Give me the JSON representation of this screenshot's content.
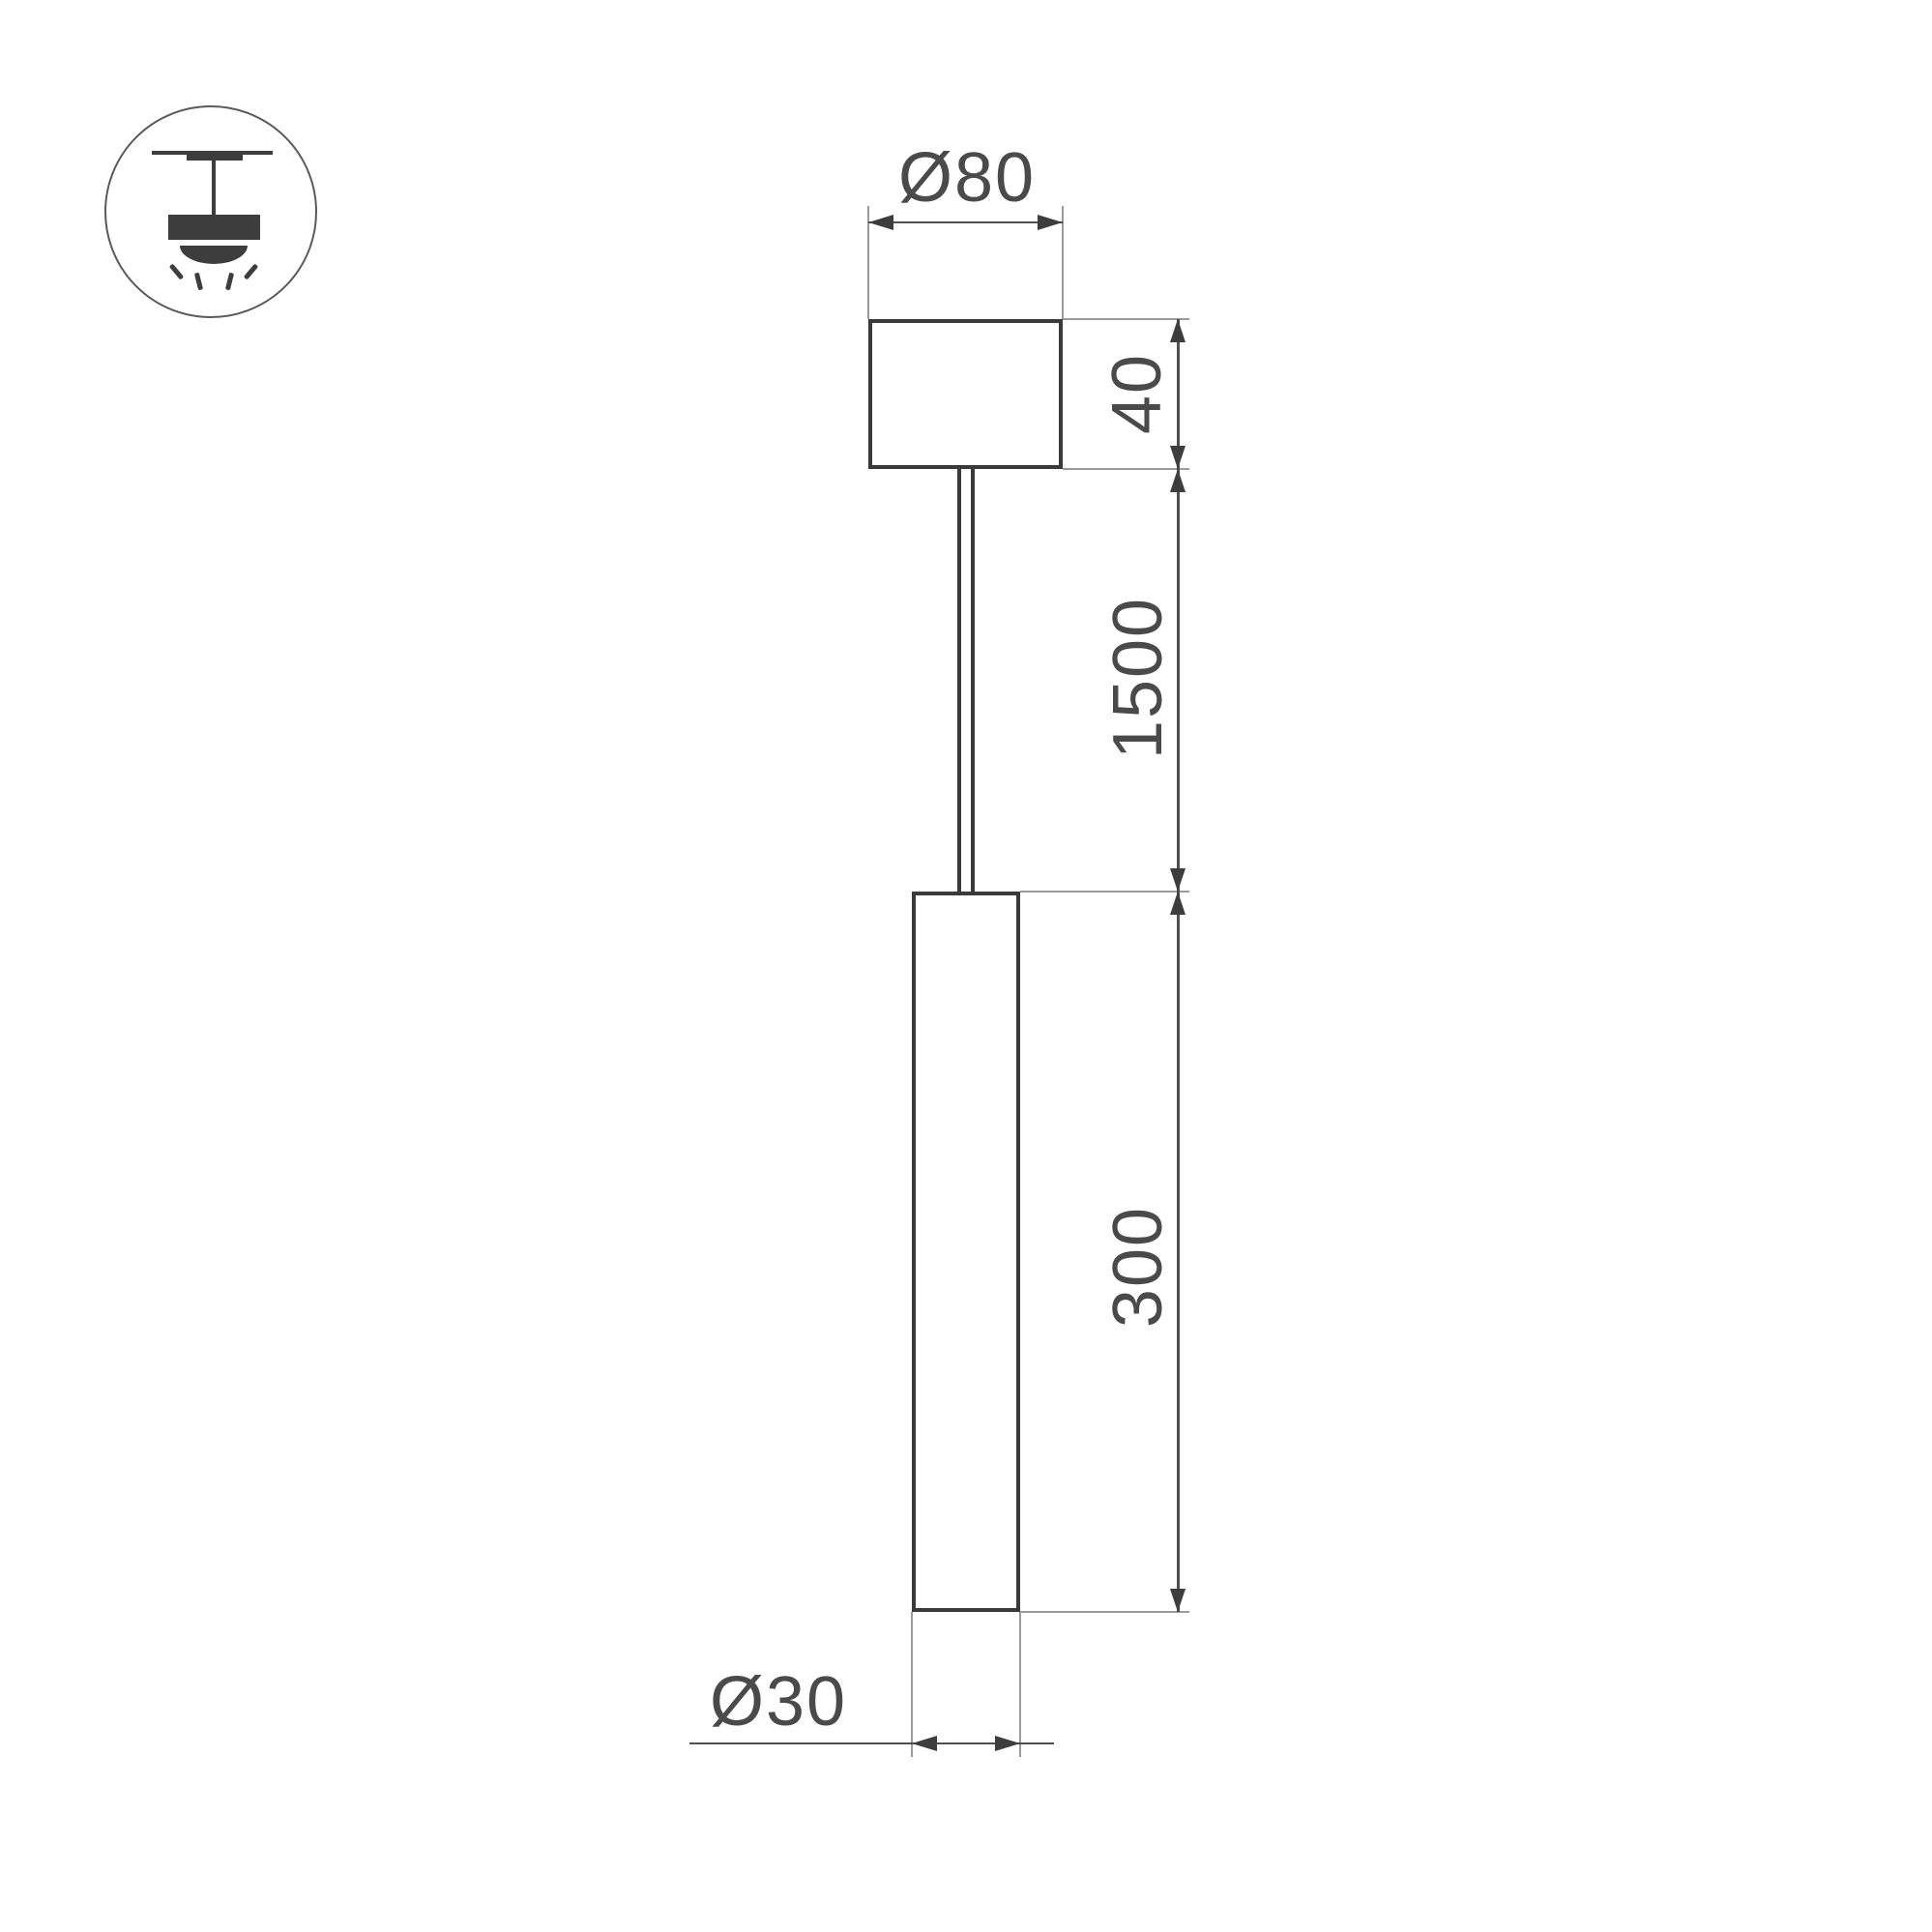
{
  "page": {
    "background": "#ffffff"
  },
  "colors": {
    "outline": "#3a3a3a",
    "dimension_line": "#4f4f4f",
    "extension_line": "#9b9b9b",
    "arrow": "#3d3d3d",
    "text": "#4a4a4a",
    "icon": "#3d3d3d",
    "icon_circle": "#5a5a5a"
  },
  "labels": {
    "canopy_diameter": "Ø80",
    "canopy_height": "40",
    "suspension_length": "1500",
    "tube_length": "300",
    "tube_diameter": "Ø30"
  },
  "icon": {
    "name": "ceiling-pendant-light"
  }
}
